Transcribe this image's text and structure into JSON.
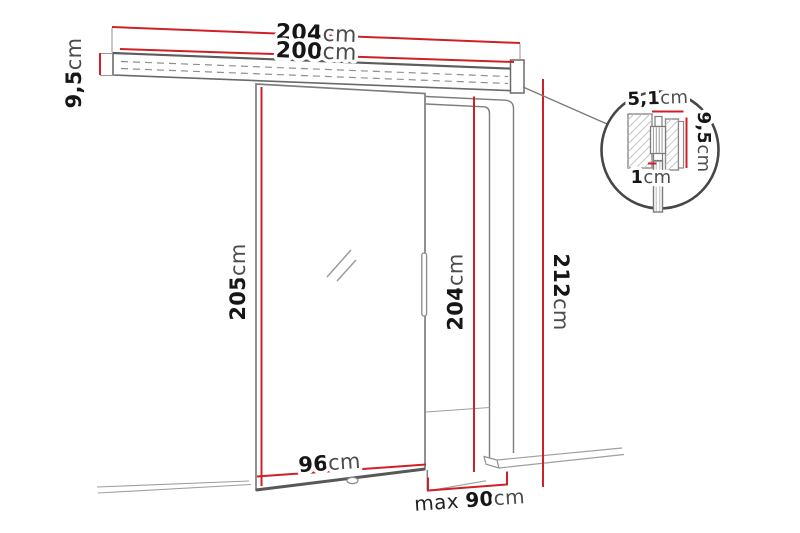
{
  "dims": {
    "rail_total": {
      "value": "204",
      "unit": "cm"
    },
    "rail_inner": {
      "value": "200",
      "unit": "cm"
    },
    "rail_height": {
      "value": "9,5",
      "unit": "cm"
    },
    "door_height": {
      "value": "205",
      "unit": "cm"
    },
    "door_width": {
      "value": "96",
      "unit": "cm"
    },
    "opening_height": {
      "value": "204",
      "unit": "cm"
    },
    "total_height": {
      "value": "212",
      "unit": "cm"
    },
    "opening_width": {
      "prefix": "max ",
      "value": "90",
      "unit": "cm"
    },
    "detail_track_width": {
      "value": "5,1",
      "unit": "cm"
    },
    "detail_track_height": {
      "value": "9,5",
      "unit": "cm"
    },
    "detail_panel_thickness": {
      "value": "1",
      "unit": "cm"
    }
  },
  "colors": {
    "dimension_red": "#d02027",
    "outline_gray": "#7d7d7d",
    "background": "#ffffff"
  }
}
